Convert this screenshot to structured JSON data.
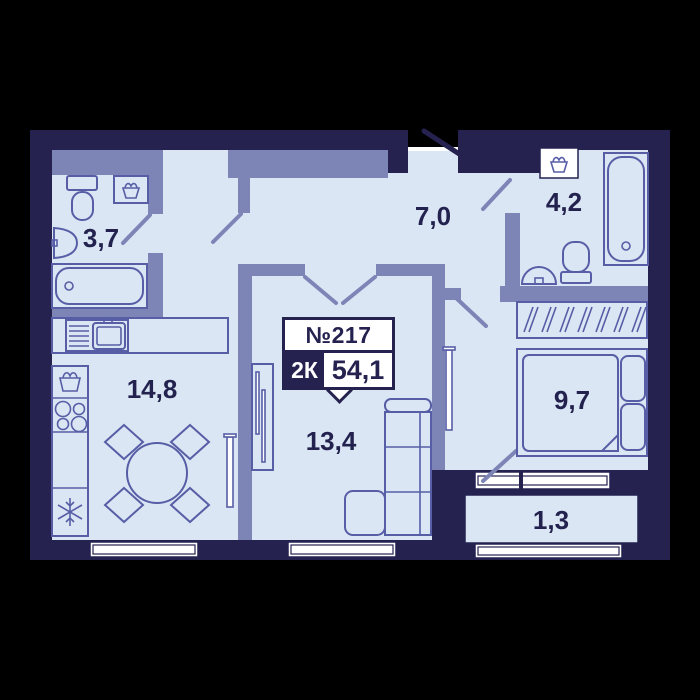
{
  "plan": {
    "apartment": {
      "number": "№217",
      "type": "2К",
      "total_area": "54,1"
    },
    "rooms": [
      {
        "name": "bathroom-small",
        "area": "3,7"
      },
      {
        "name": "hallway",
        "area": "7,0"
      },
      {
        "name": "bathroom-large",
        "area": "4,2"
      },
      {
        "name": "kitchen",
        "area": "14,8"
      },
      {
        "name": "living-room",
        "area": "13,4"
      },
      {
        "name": "bedroom",
        "area": "9,7"
      },
      {
        "name": "balcony",
        "area": "1,3"
      }
    ],
    "icons": {
      "toilet-icon": "toilet outline",
      "bathtub-icon": "bathtub outline",
      "sink-icon": "wash basin",
      "laundry-basket-icon": "basket with cloth",
      "stove-icon": "4 burner circles",
      "fridge-icon": "snowflake",
      "dining-table-icon": "round table with 4 chairs",
      "sofa-icon": "corner sofa",
      "bed-icon": "double bed with pillows",
      "wardrobe-icon": "hanger hatching",
      "tv-icon": "thin wall panel",
      "door-icon": "swing leaf line",
      "window-icon": "double framed strip"
    }
  },
  "colors": {
    "background": "#000000",
    "wall": "#252250",
    "partition": "#7d85b7",
    "floor": "#dae6f4",
    "furniture": "#575ea6",
    "label": "#23224f",
    "window": "#ffffff"
  }
}
